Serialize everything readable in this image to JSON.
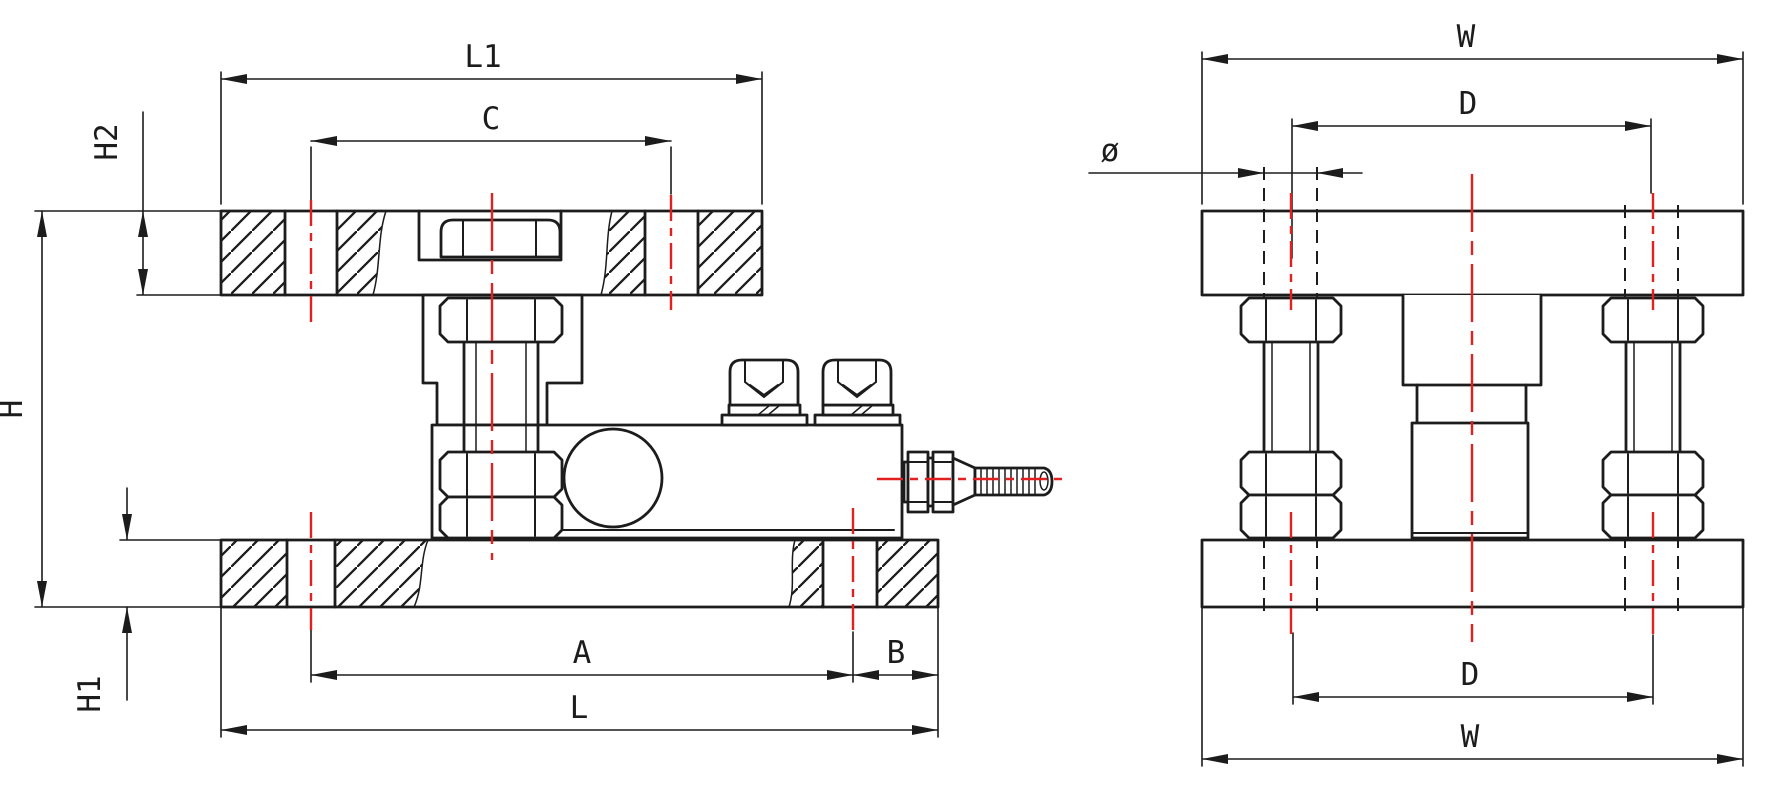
{
  "colors": {
    "line": "#1c1c1c",
    "centerline": "#e32020",
    "bg": "#ffffff"
  },
  "dims": {
    "L1": "L1",
    "C": "C",
    "H2": "H2",
    "H": "H",
    "H1": "H1",
    "A": "A",
    "B": "B",
    "L": "L",
    "W": "W",
    "D": "D",
    "diameter": "ø"
  }
}
